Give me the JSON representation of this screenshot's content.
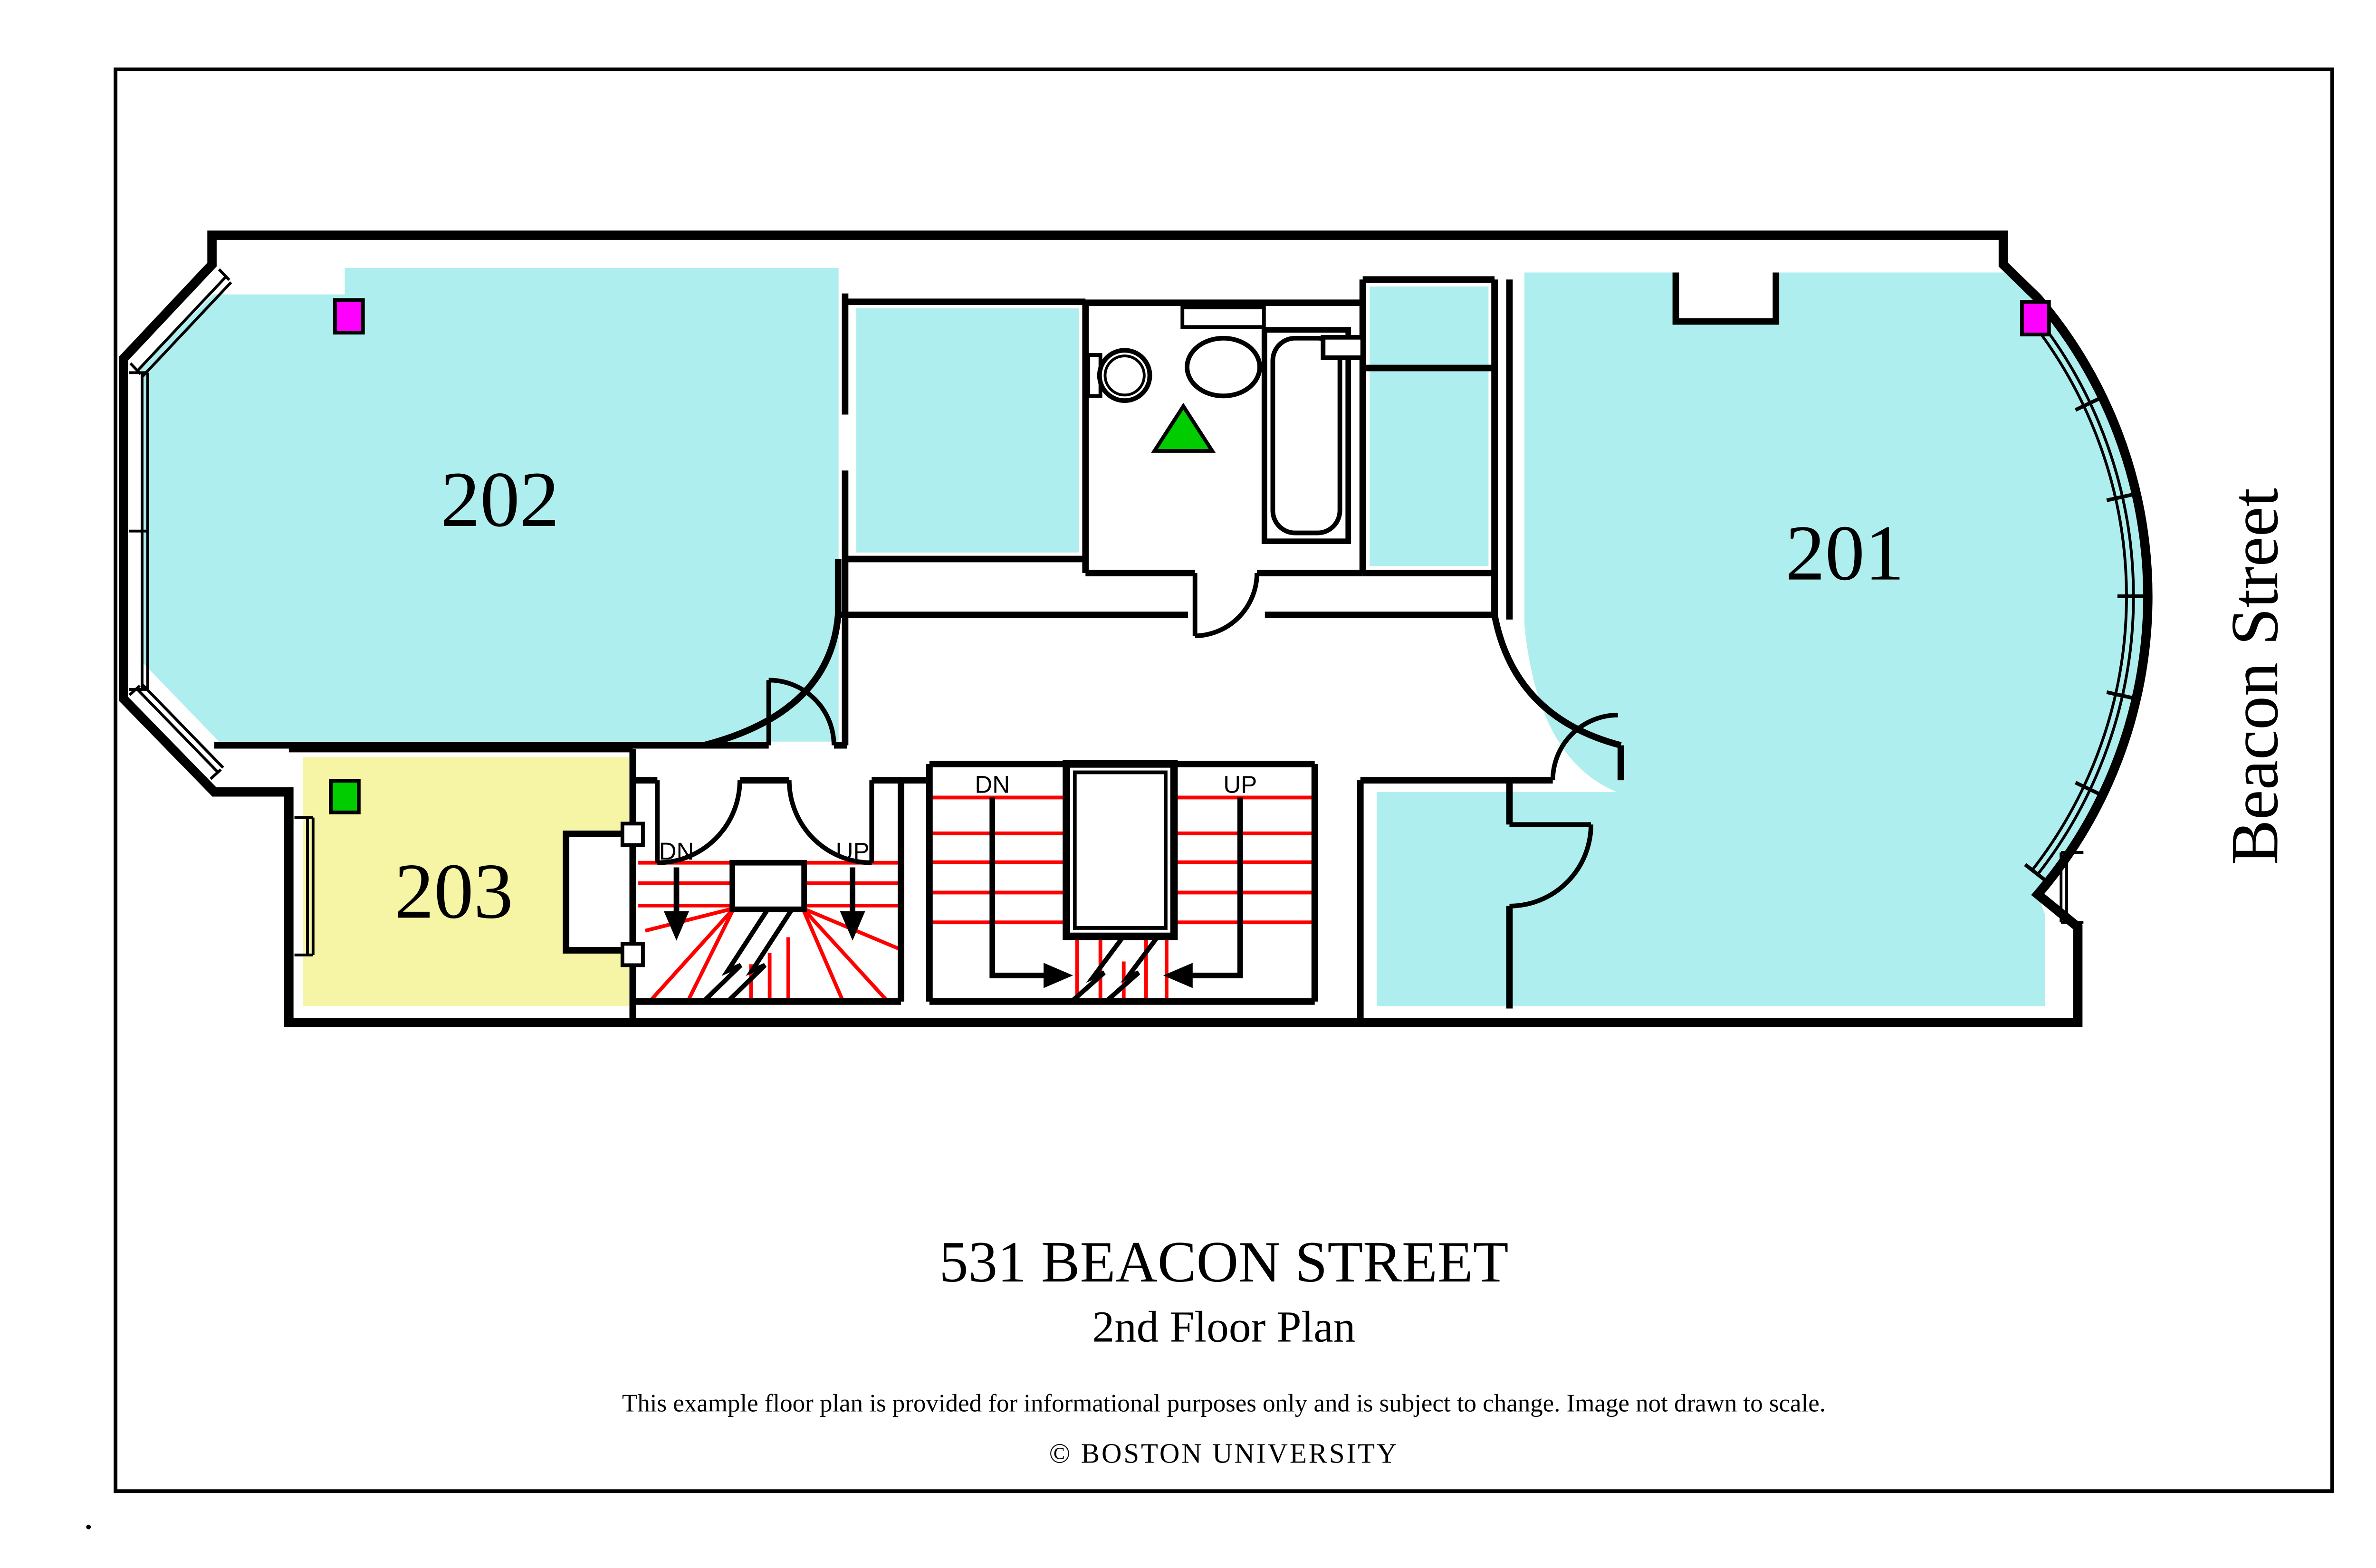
{
  "plan": {
    "rooms": [
      {
        "number": "202",
        "kind": "bedroom",
        "fill_key": "room_cyan"
      },
      {
        "number": "201",
        "kind": "bedroom",
        "fill_key": "room_cyan"
      },
      {
        "number": "203",
        "kind": "bedroom",
        "fill_key": "room_yellow"
      }
    ],
    "stair_labels": {
      "down": "DN",
      "up": "UP"
    },
    "street": "Beacon Street",
    "markers": [
      {
        "name": "magenta-square-room-202",
        "color_key": "marker_magenta"
      },
      {
        "name": "magenta-square-room-201",
        "color_key": "marker_magenta"
      },
      {
        "name": "green-square-room-203",
        "color_key": "marker_green"
      },
      {
        "name": "green-triangle-bathroom",
        "color_key": "marker_green"
      }
    ],
    "fixtures": [
      "toilet",
      "sink",
      "bathtub"
    ],
    "colors": {
      "room_cyan": "#AFEEEE",
      "room_yellow": "#F5F5A5",
      "marker_magenta": "#FF00FF",
      "marker_green": "#00CC00",
      "stair_red": "#FF0000",
      "wall": "#000000"
    }
  },
  "titleblock": {
    "title": "531 BEACON STREET",
    "subtitle": "2nd Floor Plan",
    "disclaimer": "This example floor plan is provided for informational purposes only and is subject to change. Image not drawn to scale.",
    "copyright": "© BOSTON UNIVERSITY"
  }
}
